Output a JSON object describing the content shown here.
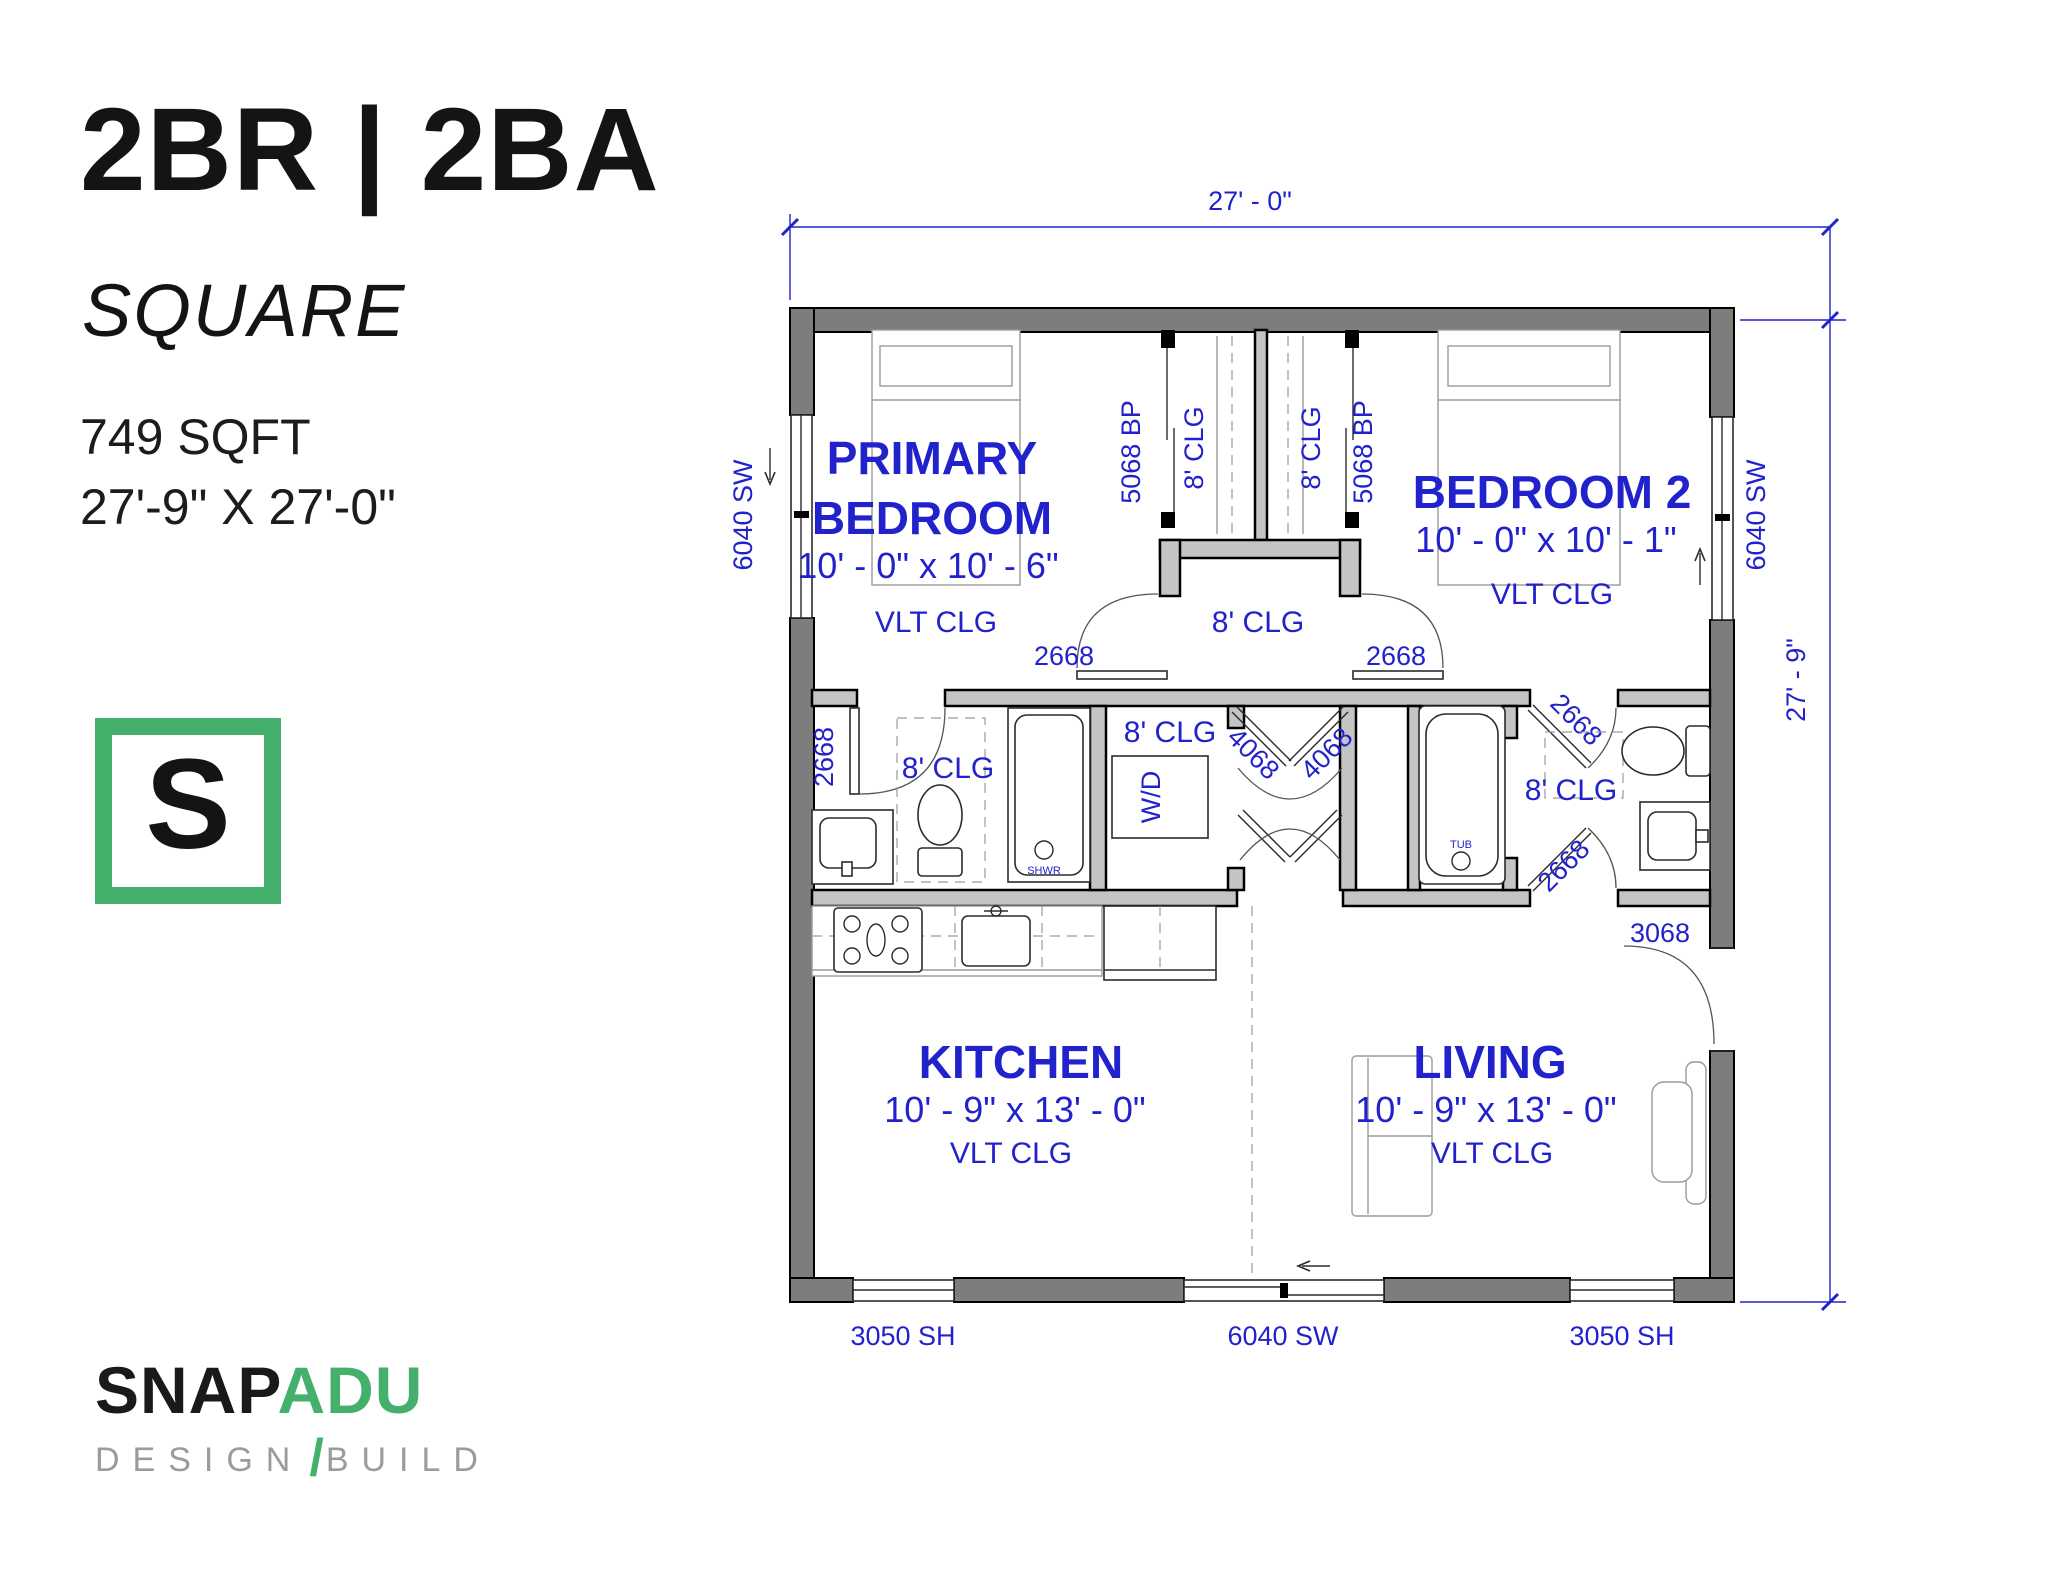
{
  "sidebar": {
    "title": "2BR | 2BA",
    "subtitle": "SQUARE",
    "sqft": "749 SQFT",
    "overall_dims": "27'-9\" X 27'-0\"",
    "logo_letter": "S",
    "brand_snap": "SNAP",
    "brand_adu": "ADU",
    "brand_design": "DESIGN",
    "brand_slash": "/",
    "brand_build": "BUILD"
  },
  "plan": {
    "dim_width": "27' - 0\"",
    "dim_height": "27' - 9\"",
    "primary_bedroom": {
      "line1": "PRIMARY",
      "line2": "BEDROOM",
      "size": "10' - 0\" x 10' - 6\"",
      "ceiling": "VLT CLG"
    },
    "bedroom2": {
      "name": "BEDROOM 2",
      "size": "10' - 0\" x 10' - 1\"",
      "ceiling": "VLT CLG"
    },
    "kitchen": {
      "name": "KITCHEN",
      "size": "10' - 9\" x 13' - 0\"",
      "ceiling": "VLT CLG"
    },
    "living": {
      "name": "LIVING",
      "size": "10' - 9\" x 13' - 0\"",
      "ceiling": "VLT CLG"
    },
    "labels": {
      "clg8": "8' CLG",
      "bypass5068": "5068 BP",
      "door2668": "2668",
      "door3068": "3068",
      "door4068": "4068",
      "window6040": "6040 SW",
      "window3050": "3050 SH",
      "wd": "W/D",
      "shwr": "SHWR",
      "tub": "TUB"
    }
  },
  "colors": {
    "accent_blue": "#2222cc",
    "brand_green": "#45b06c",
    "wall_dark": "#7d7d7d",
    "wall_light": "#c4c4c4"
  }
}
